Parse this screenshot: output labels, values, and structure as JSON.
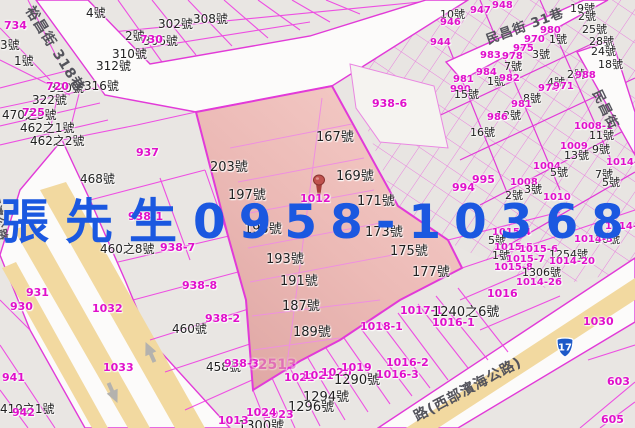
{
  "map": {
    "phone_overlay": {
      "prefix": "張先生",
      "number": "0958-103680",
      "color": "#1b58e0"
    },
    "highway_shield": {
      "number": "17"
    },
    "colors": {
      "parcel_line": "#ee3fe2",
      "parcel_number_text": "#e010cb",
      "house_number_text": "#1f1f1f",
      "road_fill": "#fcfbfa",
      "highlight_parcel_fill": "#ecbab6",
      "road_yellow": "#f2d9a0",
      "overlay_blue": "#1b58e0",
      "shield_blue": "#1d5ac8"
    },
    "labels": [
      {
        "t": "734",
        "x": 4,
        "y": 19,
        "c": "m"
      },
      {
        "t": "3號",
        "x": 0,
        "y": 36,
        "c": "b"
      },
      {
        "t": "1號",
        "x": 14,
        "y": 52,
        "c": "b"
      },
      {
        "t": "4號",
        "x": 86,
        "y": 4,
        "c": "b"
      },
      {
        "t": "2號",
        "x": 125,
        "y": 27,
        "c": "b"
      },
      {
        "t": "306號",
        "x": 143,
        "y": 32,
        "c": "b"
      },
      {
        "t": "730",
        "x": 140,
        "y": 33,
        "c": "m"
      },
      {
        "t": "302號",
        "x": 158,
        "y": 15,
        "c": "b"
      },
      {
        "t": "308號",
        "x": 193,
        "y": 10,
        "c": "b"
      },
      {
        "t": "310號",
        "x": 112,
        "y": 45,
        "c": "b"
      },
      {
        "t": "312號",
        "x": 96,
        "y": 57,
        "c": "b"
      },
      {
        "t": "316號",
        "x": 84,
        "y": 77,
        "c": "b"
      },
      {
        "t": "320號",
        "x": 49,
        "y": 79,
        "c": "b"
      },
      {
        "t": "720",
        "x": 46,
        "y": 80,
        "c": "m"
      },
      {
        "t": "322號",
        "x": 32,
        "y": 91,
        "c": "b"
      },
      {
        "t": "470之5號",
        "x": 2,
        "y": 106,
        "c": "b"
      },
      {
        "t": "725",
        "x": 22,
        "y": 106,
        "c": "m"
      },
      {
        "t": "462之1號",
        "x": 20,
        "y": 119,
        "c": "b"
      },
      {
        "t": "462之2號",
        "x": 30,
        "y": 132,
        "c": "b"
      },
      {
        "t": "937",
        "x": 136,
        "y": 146,
        "c": "m"
      },
      {
        "t": "468號",
        "x": 80,
        "y": 170,
        "c": "b"
      },
      {
        "t": "938-1",
        "x": 128,
        "y": 210,
        "c": "m"
      },
      {
        "t": "460之8號",
        "x": 100,
        "y": 240,
        "c": "b"
      },
      {
        "t": "938-7",
        "x": 160,
        "y": 241,
        "c": "m"
      },
      {
        "t": "938-8",
        "x": 182,
        "y": 279,
        "c": "m"
      },
      {
        "t": "460號",
        "x": 172,
        "y": 320,
        "c": "b"
      },
      {
        "t": "458號",
        "x": 206,
        "y": 358,
        "c": "b"
      },
      {
        "t": "938-3",
        "x": 224,
        "y": 357,
        "c": "m"
      },
      {
        "t": "938-2",
        "x": 205,
        "y": 312,
        "c": "m"
      },
      {
        "t": "02513",
        "x": 248,
        "y": 357,
        "c": "m",
        "s": 14,
        "o": 0.38
      },
      {
        "t": "931",
        "x": 26,
        "y": 286,
        "c": "m"
      },
      {
        "t": "930",
        "x": 10,
        "y": 300,
        "c": "m"
      },
      {
        "t": "1032",
        "x": 92,
        "y": 302,
        "c": "m"
      },
      {
        "t": "1033",
        "x": 103,
        "y": 361,
        "c": "m"
      },
      {
        "t": "941",
        "x": 2,
        "y": 371,
        "c": "m"
      },
      {
        "t": "419之1號",
        "x": 0,
        "y": 400,
        "c": "b"
      },
      {
        "t": "942",
        "x": 12,
        "y": 406,
        "c": "m"
      },
      {
        "t": "167號",
        "x": 316,
        "y": 126,
        "c": "b",
        "s": 13
      },
      {
        "t": "203號",
        "x": 210,
        "y": 156,
        "c": "b",
        "s": 13
      },
      {
        "t": "169號",
        "x": 336,
        "y": 165,
        "c": "b",
        "s": 13
      },
      {
        "t": "197號",
        "x": 228,
        "y": 184,
        "c": "b",
        "s": 13
      },
      {
        "t": "171號",
        "x": 357,
        "y": 190,
        "c": "b",
        "s": 13
      },
      {
        "t": "195號",
        "x": 244,
        "y": 218,
        "c": "b",
        "s": 13
      },
      {
        "t": "173號",
        "x": 365,
        "y": 221,
        "c": "b",
        "s": 13
      },
      {
        "t": "175號",
        "x": 390,
        "y": 240,
        "c": "b",
        "s": 13
      },
      {
        "t": "193號",
        "x": 266,
        "y": 248,
        "c": "b",
        "s": 13
      },
      {
        "t": "177號",
        "x": 412,
        "y": 261,
        "c": "b",
        "s": 13
      },
      {
        "t": "191號",
        "x": 280,
        "y": 270,
        "c": "b",
        "s": 13
      },
      {
        "t": "187號",
        "x": 282,
        "y": 295,
        "c": "b",
        "s": 13
      },
      {
        "t": "189號",
        "x": 293,
        "y": 321,
        "c": "b",
        "s": 13
      },
      {
        "t": "1012",
        "x": 300,
        "y": 192,
        "c": "m"
      },
      {
        "t": "938-6",
        "x": 372,
        "y": 97,
        "c": "m"
      },
      {
        "t": "994",
        "x": 452,
        "y": 181,
        "c": "m"
      },
      {
        "t": "995",
        "x": 472,
        "y": 173,
        "c": "m"
      },
      {
        "t": "10號",
        "x": 440,
        "y": 6,
        "c": "b",
        "s": 11
      },
      {
        "t": "947",
        "x": 470,
        "y": 5,
        "c": "m",
        "s": 10
      },
      {
        "t": "948",
        "x": 492,
        "y": 0,
        "c": "m",
        "s": 10
      },
      {
        "t": "946",
        "x": 440,
        "y": 17,
        "c": "m",
        "s": 10
      },
      {
        "t": "944",
        "x": 430,
        "y": 37,
        "c": "m",
        "s": 10
      },
      {
        "t": "980",
        "x": 540,
        "y": 25,
        "c": "m",
        "s": 10
      },
      {
        "t": "1號",
        "x": 549,
        "y": 31,
        "c": "b",
        "s": 11
      },
      {
        "t": "970",
        "x": 524,
        "y": 34,
        "c": "m",
        "s": 10
      },
      {
        "t": "975",
        "x": 513,
        "y": 43,
        "c": "m",
        "s": 10
      },
      {
        "t": "3號",
        "x": 532,
        "y": 46,
        "c": "b",
        "s": 11
      },
      {
        "t": "983",
        "x": 480,
        "y": 50,
        "c": "m",
        "s": 10
      },
      {
        "t": "978",
        "x": 502,
        "y": 51,
        "c": "m",
        "s": 10
      },
      {
        "t": "7號",
        "x": 504,
        "y": 58,
        "c": "b",
        "s": 11
      },
      {
        "t": "19號",
        "x": 570,
        "y": 0,
        "c": "b",
        "s": 11
      },
      {
        "t": "2號",
        "x": 578,
        "y": 8,
        "c": "b",
        "s": 11
      },
      {
        "t": "25號",
        "x": 582,
        "y": 21,
        "c": "b",
        "s": 11
      },
      {
        "t": "28號",
        "x": 589,
        "y": 33,
        "c": "b",
        "s": 11
      },
      {
        "t": "24號",
        "x": 591,
        "y": 43,
        "c": "b",
        "s": 11
      },
      {
        "t": "18號",
        "x": 598,
        "y": 56,
        "c": "b",
        "s": 11
      },
      {
        "t": "984",
        "x": 476,
        "y": 67,
        "c": "m",
        "s": 10
      },
      {
        "t": "981",
        "x": 453,
        "y": 74,
        "c": "m",
        "s": 10
      },
      {
        "t": "1號",
        "x": 487,
        "y": 73,
        "c": "b",
        "s": 11
      },
      {
        "t": "982",
        "x": 499,
        "y": 73,
        "c": "m",
        "s": 10
      },
      {
        "t": "2號",
        "x": 567,
        "y": 66,
        "c": "b",
        "s": 11
      },
      {
        "t": "988",
        "x": 575,
        "y": 70,
        "c": "m",
        "s": 10
      },
      {
        "t": "4號",
        "x": 547,
        "y": 74,
        "c": "b",
        "s": 11
      },
      {
        "t": "974",
        "x": 538,
        "y": 83,
        "c": "m",
        "s": 10
      },
      {
        "t": "971",
        "x": 553,
        "y": 81,
        "c": "m",
        "s": 10
      },
      {
        "t": "990",
        "x": 450,
        "y": 84,
        "c": "m",
        "s": 10
      },
      {
        "t": "15號",
        "x": 454,
        "y": 86,
        "c": "b",
        "s": 11
      },
      {
        "t": "8號",
        "x": 523,
        "y": 90,
        "c": "b",
        "s": 11
      },
      {
        "t": "981",
        "x": 511,
        "y": 99,
        "c": "m",
        "s": 10
      },
      {
        "t": "12號",
        "x": 496,
        "y": 107,
        "c": "b",
        "s": 11
      },
      {
        "t": "986",
        "x": 487,
        "y": 112,
        "c": "m",
        "s": 10
      },
      {
        "t": "16號",
        "x": 470,
        "y": 124,
        "c": "b",
        "s": 11
      },
      {
        "t": "1008-1",
        "x": 574,
        "y": 121,
        "c": "m",
        "s": 10
      },
      {
        "t": "11號",
        "x": 589,
        "y": 127,
        "c": "b",
        "s": 11
      },
      {
        "t": "1009",
        "x": 560,
        "y": 141,
        "c": "m",
        "s": 10
      },
      {
        "t": "13號",
        "x": 564,
        "y": 147,
        "c": "b",
        "s": 11
      },
      {
        "t": "9號",
        "x": 592,
        "y": 141,
        "c": "b",
        "s": 11
      },
      {
        "t": "1004",
        "x": 533,
        "y": 161,
        "c": "m",
        "s": 10
      },
      {
        "t": "5號",
        "x": 550,
        "y": 164,
        "c": "b",
        "s": 11
      },
      {
        "t": "7號",
        "x": 595,
        "y": 166,
        "c": "b",
        "s": 11
      },
      {
        "t": "1014-8",
        "x": 606,
        "y": 157,
        "c": "m",
        "s": 10
      },
      {
        "t": "5號",
        "x": 602,
        "y": 174,
        "c": "b",
        "s": 11
      },
      {
        "t": "1008",
        "x": 510,
        "y": 177,
        "c": "m",
        "s": 10
      },
      {
        "t": "3號",
        "x": 524,
        "y": 181,
        "c": "b",
        "s": 11
      },
      {
        "t": "2號",
        "x": 505,
        "y": 187,
        "c": "b",
        "s": 11
      },
      {
        "t": "1010",
        "x": 543,
        "y": 192,
        "c": "m",
        "s": 10
      },
      {
        "t": "1014-2",
        "x": 605,
        "y": 221,
        "c": "m",
        "s": 10
      },
      {
        "t": "20號",
        "x": 595,
        "y": 231,
        "c": "b",
        "s": 11
      },
      {
        "t": "1014-3",
        "x": 574,
        "y": 234,
        "c": "m",
        "s": 10
      },
      {
        "t": "1015-4",
        "x": 492,
        "y": 227,
        "c": "m",
        "s": 10
      },
      {
        "t": "5號",
        "x": 488,
        "y": 232,
        "c": "b",
        "s": 11
      },
      {
        "t": "1015-5",
        "x": 494,
        "y": 242,
        "c": "m",
        "s": 10
      },
      {
        "t": "1號",
        "x": 492,
        "y": 247,
        "c": "b",
        "s": 11
      },
      {
        "t": "1015-6",
        "x": 519,
        "y": 244,
        "c": "m",
        "s": 10
      },
      {
        "t": "1254號",
        "x": 549,
        "y": 246,
        "c": "b",
        "s": 11
      },
      {
        "t": "1015-7",
        "x": 506,
        "y": 254,
        "c": "m",
        "s": 10
      },
      {
        "t": "1014-20",
        "x": 549,
        "y": 256,
        "c": "m",
        "s": 10
      },
      {
        "t": "1015-8",
        "x": 494,
        "y": 262,
        "c": "m",
        "s": 10
      },
      {
        "t": "1306號",
        "x": 522,
        "y": 264,
        "c": "b",
        "s": 11
      },
      {
        "t": "1022",
        "x": 284,
        "y": 371,
        "c": "m"
      },
      {
        "t": "1021",
        "x": 303,
        "y": 369,
        "c": "m"
      },
      {
        "t": "1020",
        "x": 321,
        "y": 366,
        "c": "m"
      },
      {
        "t": "1019",
        "x": 341,
        "y": 361,
        "c": "m"
      },
      {
        "t": "1290號",
        "x": 334,
        "y": 369,
        "c": "b",
        "s": 13
      },
      {
        "t": "1016-2",
        "x": 386,
        "y": 356,
        "c": "m"
      },
      {
        "t": "1016-3",
        "x": 376,
        "y": 368,
        "c": "m"
      },
      {
        "t": "1294號",
        "x": 303,
        "y": 386,
        "c": "b",
        "s": 13
      },
      {
        "t": "1296號",
        "x": 288,
        "y": 396,
        "c": "b",
        "s": 13
      },
      {
        "t": "1023",
        "x": 263,
        "y": 408,
        "c": "m"
      },
      {
        "t": "1024",
        "x": 246,
        "y": 406,
        "c": "m"
      },
      {
        "t": "1300號",
        "x": 238,
        "y": 415,
        "c": "b",
        "s": 13
      },
      {
        "t": "1013",
        "x": 218,
        "y": 414,
        "c": "m"
      },
      {
        "t": "1018-1",
        "x": 360,
        "y": 320,
        "c": "m"
      },
      {
        "t": "1017-1",
        "x": 400,
        "y": 304,
        "c": "m"
      },
      {
        "t": "1240之6號",
        "x": 432,
        "y": 301,
        "c": "b",
        "s": 13
      },
      {
        "t": "1016-1",
        "x": 432,
        "y": 316,
        "c": "m"
      },
      {
        "t": "1016",
        "x": 487,
        "y": 287,
        "c": "m"
      },
      {
        "t": "1014-26",
        "x": 516,
        "y": 277,
        "c": "m",
        "s": 10
      },
      {
        "t": "1030",
        "x": 583,
        "y": 315,
        "c": "m"
      },
      {
        "t": "603",
        "x": 607,
        "y": 375,
        "c": "m"
      },
      {
        "t": "605",
        "x": 601,
        "y": 413,
        "c": "m"
      },
      {
        "t": "裕昌街 318巷",
        "x": 38,
        "y": 2,
        "c": "r",
        "r": 58,
        "s": 14
      },
      {
        "t": "民昌街 31巷",
        "x": 483,
        "y": 30,
        "c": "r",
        "r": -20,
        "s": 13
      },
      {
        "t": "民昌街",
        "x": 606,
        "y": 86,
        "c": "r",
        "r": 64,
        "s": 13
      },
      {
        "t": "路(西部濱海公路)",
        "x": 410,
        "y": 408,
        "c": "r",
        "r": -28,
        "s": 14
      },
      {
        "t": "西濱公路",
        "x": 2,
        "y": 192,
        "c": "r",
        "r": 78,
        "s": 11
      }
    ]
  }
}
